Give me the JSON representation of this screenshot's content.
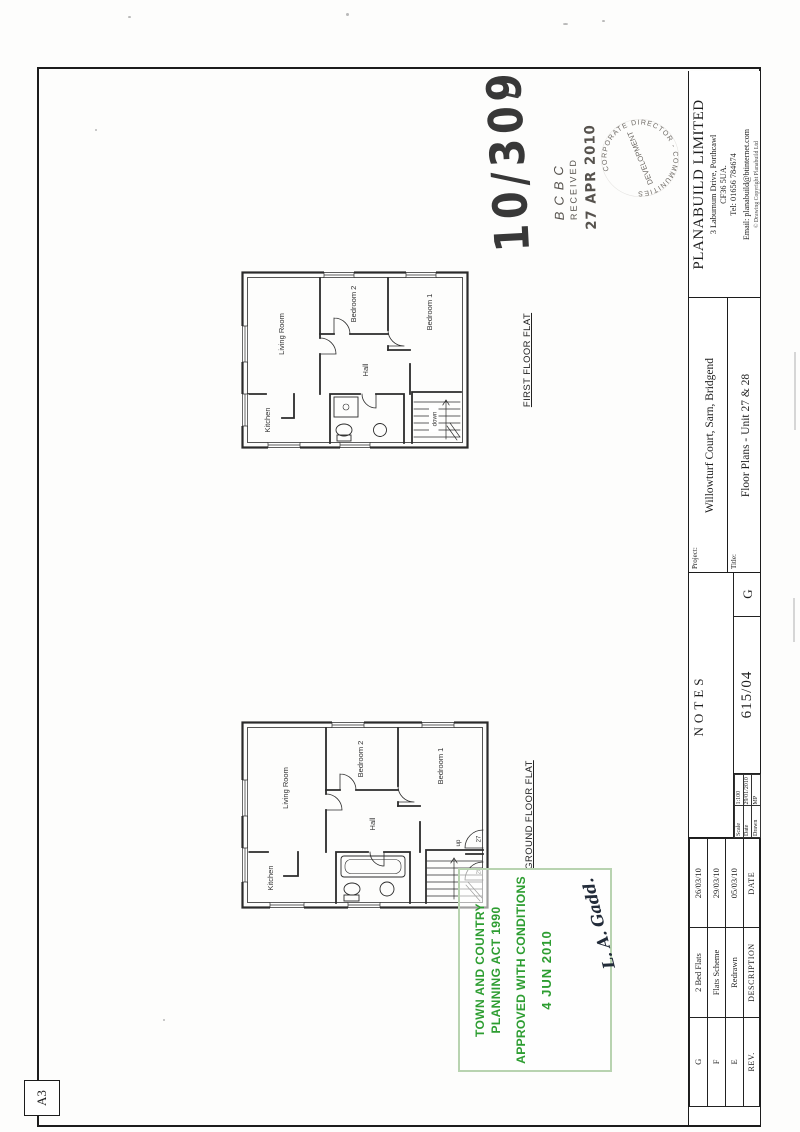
{
  "sheet": {
    "size_label": "A3",
    "title_block": {
      "company": {
        "name": "PLANABUILD LIMITED",
        "address_line1": "3 Laburnum Drive, Porthcawl",
        "address_line2": "CF36 5UA.",
        "tel": "Tel: 01656 784674",
        "email": "Email: planabuild@btinternet.com",
        "copyright": "© Drawing Copyright Planabuild Ltd"
      },
      "project": {
        "label": "Project:",
        "value": "Willowturf Court, Sarn, Bridgend"
      },
      "title": {
        "label": "Title:",
        "value": "Floor Plans - Unit 27 & 28"
      },
      "notes_header": "NOTES",
      "scale": {
        "label": "Scale",
        "value": "1:100"
      },
      "date": {
        "label": "Date",
        "value": "29/01/2010"
      },
      "drawn": {
        "label": "Drawn",
        "value": "MP"
      },
      "drawing_number": "615/04",
      "current_revision": "G",
      "revision_table": {
        "header": {
          "rev": "REV.",
          "description": "DESCRIPTION",
          "date": "DATE"
        },
        "rows": [
          {
            "rev": "G",
            "description": "2 Bed Flats",
            "date": "26/03/10"
          },
          {
            "rev": "F",
            "description": "Flats Scheme",
            "date": "29/03/10"
          },
          {
            "rev": "E",
            "description": "Redrawn",
            "date": "05/03/10"
          }
        ]
      }
    },
    "plans": {
      "ground": {
        "caption": "GROUND FLOOR FLAT",
        "rooms": {
          "kitchen": "Kitchen",
          "living": "Living Room",
          "bedroom2": "Bedroom 2",
          "bedroom1": "Bedroom 1",
          "hall": "Hall"
        },
        "stairs_label": "up",
        "door_labels": {
          "flat27": "27",
          "flat28": "28"
        }
      },
      "first": {
        "caption": "FIRST FLOOR FLAT",
        "rooms": {
          "kitchen": "Kitchen",
          "living": "Living Room",
          "bedroom2": "Bedroom 2",
          "bedroom1": "Bedroom 1",
          "hall": "Hall"
        },
        "stairs_label": "down"
      }
    },
    "stamps": {
      "handwritten_ref": "10/309",
      "received": {
        "org": "BCBC",
        "status": "RECEIVED",
        "date": "27 APR 2010"
      },
      "circular": {
        "ring_text": "CORPORATE DIRECTOR - COMMUNITIES",
        "center_text": "DEVELOPMENT"
      },
      "approval": {
        "line1": "TOWN AND COUNTRY",
        "line2": "PLANNING ACT 1990",
        "line3": "APPROVED WITH CONDITIONS",
        "date": "4 JUN 2010",
        "signature": "L. A. Gadd."
      }
    },
    "colors": {
      "approval_green": "#2d9d31",
      "stamp_ink": "#55504a",
      "line_ink": "#2b2b2b"
    }
  }
}
